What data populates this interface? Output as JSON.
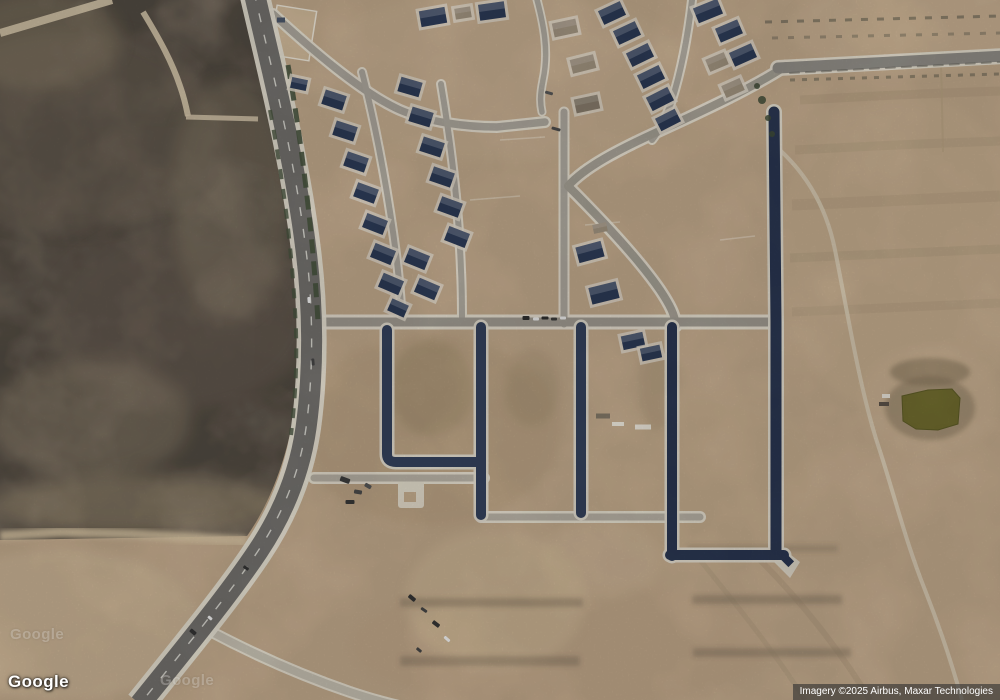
{
  "branding": {
    "logo_text": "Google"
  },
  "attribution": {
    "text": "Imagery ©2025 Airbus, Maxar Technologies"
  },
  "watermarks": [
    {
      "text": "Google"
    },
    {
      "text": "Google"
    }
  ],
  "colors": {
    "terrain_tan": "#bfa78a",
    "scrub_field": "#84786a",
    "arterial_asphalt": "#716f6c",
    "new_asphalt_dark": "#2e3a52",
    "light_street": "#a5a098",
    "curb_white": "#e2dcce",
    "roof_navy": "#2c3a55",
    "roof_frame": "#9b8e7b",
    "pond_olive": "#6e6a2e",
    "vegetation_green": "#46523d",
    "attribution_bg": "rgba(48,48,48,0.62)",
    "text_white": "#ffffff"
  },
  "map_features": {
    "houses": [
      {
        "x": 334,
        "y": 100,
        "r": 18
      },
      {
        "x": 345,
        "y": 131,
        "r": 18
      },
      {
        "x": 356,
        "y": 162,
        "r": 19
      },
      {
        "x": 366,
        "y": 193,
        "r": 20
      },
      {
        "x": 375,
        "y": 224,
        "r": 21
      },
      {
        "x": 383,
        "y": 254,
        "r": 22
      },
      {
        "x": 391,
        "y": 284,
        "r": 23
      },
      {
        "x": 398,
        "y": 308,
        "r": 24,
        "w": 18,
        "h": 13
      },
      {
        "x": 410,
        "y": 87,
        "r": 16
      },
      {
        "x": 421,
        "y": 117,
        "r": 17
      },
      {
        "x": 432,
        "y": 147,
        "r": 18
      },
      {
        "x": 442,
        "y": 177,
        "r": 19
      },
      {
        "x": 450,
        "y": 207,
        "r": 20
      },
      {
        "x": 457,
        "y": 237,
        "r": 21
      },
      {
        "x": 417,
        "y": 259,
        "r": 22
      },
      {
        "x": 427,
        "y": 289,
        "r": 23
      },
      {
        "x": 433,
        "y": 17,
        "r": -10,
        "w": 26,
        "h": 16
      },
      {
        "x": 492,
        "y": 11,
        "r": -8,
        "w": 26,
        "h": 16
      },
      {
        "x": 463,
        "y": 13,
        "r": -9,
        "w": 16,
        "h": 11,
        "c": "#9b8e7b"
      },
      {
        "x": 565,
        "y": 28,
        "r": -12,
        "w": 24,
        "h": 14,
        "c": "#9b8e7b"
      },
      {
        "x": 583,
        "y": 64,
        "r": -14,
        "w": 24,
        "h": 14,
        "c": "#9b8e7b"
      },
      {
        "x": 587,
        "y": 104,
        "r": -12,
        "w": 24,
        "h": 14,
        "c": "#857a69"
      },
      {
        "x": 612,
        "y": 13,
        "r": -25,
        "w": 24,
        "h": 15
      },
      {
        "x": 627,
        "y": 33,
        "r": -25,
        "w": 24,
        "h": 15
      },
      {
        "x": 640,
        "y": 55,
        "r": -26,
        "w": 24,
        "h": 15
      },
      {
        "x": 651,
        "y": 77,
        "r": -26,
        "w": 24,
        "h": 15
      },
      {
        "x": 660,
        "y": 99,
        "r": -27,
        "w": 24,
        "h": 15
      },
      {
        "x": 668,
        "y": 120,
        "r": -27,
        "w": 22,
        "h": 14
      },
      {
        "x": 708,
        "y": 11,
        "r": -22,
        "w": 26,
        "h": 16
      },
      {
        "x": 729,
        "y": 31,
        "r": -23,
        "w": 24,
        "h": 15
      },
      {
        "x": 743,
        "y": 55,
        "r": -24,
        "w": 24,
        "h": 15
      },
      {
        "x": 717,
        "y": 62,
        "r": -23,
        "w": 20,
        "h": 13,
        "c": "#9b8e7b"
      },
      {
        "x": 733,
        "y": 88,
        "r": -24,
        "w": 20,
        "h": 13,
        "c": "#9b8e7b"
      },
      {
        "x": 590,
        "y": 252,
        "r": -15,
        "w": 26,
        "h": 16
      },
      {
        "x": 604,
        "y": 293,
        "r": -14,
        "w": 28,
        "h": 17
      },
      {
        "x": 600,
        "y": 228,
        "r": -12,
        "w": 14,
        "h": 9,
        "c": "#9b8e7b",
        "apron": false
      },
      {
        "x": 633,
        "y": 341,
        "r": -12,
        "w": 22,
        "h": 14
      },
      {
        "x": 651,
        "y": 353,
        "r": -12,
        "w": 20,
        "h": 13
      },
      {
        "x": 299,
        "y": 84,
        "r": 12,
        "w": 16,
        "h": 11
      }
    ],
    "vehicles": [
      {
        "x": 526,
        "y": 318,
        "r": 0,
        "w": 7,
        "h": 4,
        "c": "#2f2f2f"
      },
      {
        "x": 536,
        "y": 319,
        "r": 0,
        "w": 6,
        "h": 3,
        "c": "#e8e8e8"
      },
      {
        "x": 545,
        "y": 318,
        "r": 0,
        "w": 7,
        "h": 3,
        "c": "#2f2f2f"
      },
      {
        "x": 554,
        "y": 319,
        "r": 0,
        "w": 6,
        "h": 3,
        "c": "#3a3a3a"
      },
      {
        "x": 563,
        "y": 318,
        "r": 0,
        "w": 6,
        "h": 3,
        "c": "#e8e8e8"
      },
      {
        "x": 412,
        "y": 598,
        "r": 40,
        "w": 8,
        "h": 4,
        "c": "#333333"
      },
      {
        "x": 424,
        "y": 610,
        "r": 35,
        "w": 7,
        "h": 3,
        "c": "#444444"
      },
      {
        "x": 436,
        "y": 624,
        "r": 38,
        "w": 8,
        "h": 4,
        "c": "#333333"
      },
      {
        "x": 447,
        "y": 639,
        "r": 42,
        "w": 7,
        "h": 3,
        "c": "#e8e8e8"
      },
      {
        "x": 419,
        "y": 650,
        "r": 40,
        "w": 6,
        "h": 3,
        "c": "#444444"
      },
      {
        "x": 193,
        "y": 632,
        "r": 40,
        "w": 7,
        "h": 4,
        "c": "#333333"
      },
      {
        "x": 210,
        "y": 618,
        "r": 40,
        "w": 5,
        "h": 3,
        "c": "#eeeeee"
      },
      {
        "x": 246,
        "y": 568,
        "r": 35,
        "w": 6,
        "h": 3,
        "c": "#333333"
      },
      {
        "x": 313,
        "y": 362,
        "r": 85,
        "w": 7,
        "h": 3,
        "c": "#444444"
      },
      {
        "x": 309,
        "y": 300,
        "r": 85,
        "w": 6,
        "h": 3,
        "c": "#eeeeee"
      },
      {
        "x": 345,
        "y": 480,
        "r": 20,
        "w": 10,
        "h": 5,
        "c": "#3c3c3c"
      },
      {
        "x": 358,
        "y": 492,
        "r": 10,
        "w": 8,
        "h": 4,
        "c": "#4a4a4a"
      },
      {
        "x": 350,
        "y": 502,
        "r": 0,
        "w": 9,
        "h": 4,
        "c": "#383838"
      },
      {
        "x": 368,
        "y": 486,
        "r": 30,
        "w": 7,
        "h": 4,
        "c": "#555555"
      },
      {
        "x": 549,
        "y": 93,
        "r": 15,
        "w": 8,
        "h": 3,
        "c": "#555555"
      },
      {
        "x": 556,
        "y": 129,
        "r": 15,
        "w": 9,
        "h": 3,
        "c": "#4a4a4a"
      }
    ],
    "marks": [
      {
        "x": 603,
        "y": 416,
        "w": 14,
        "h": 5,
        "c": "#7e7464"
      },
      {
        "x": 618,
        "y": 424,
        "w": 12,
        "h": 4,
        "c": "#e6e1d6"
      },
      {
        "x": 643,
        "y": 427,
        "w": 16,
        "h": 5,
        "c": "#e6e1d6"
      },
      {
        "x": 886,
        "y": 396,
        "w": 8,
        "h": 4,
        "c": "#e6e1d6"
      },
      {
        "x": 884,
        "y": 404,
        "w": 10,
        "h": 4,
        "c": "#5a5248"
      },
      {
        "x": 281,
        "y": 20,
        "w": 8,
        "h": 5,
        "c": "#4a5568"
      }
    ],
    "trees": [
      {
        "x": 762,
        "y": 100,
        "rad": 4
      },
      {
        "x": 768,
        "y": 118,
        "rad": 3
      },
      {
        "x": 757,
        "y": 86,
        "rad": 3
      },
      {
        "x": 772,
        "y": 134,
        "rad": 3
      }
    ]
  }
}
